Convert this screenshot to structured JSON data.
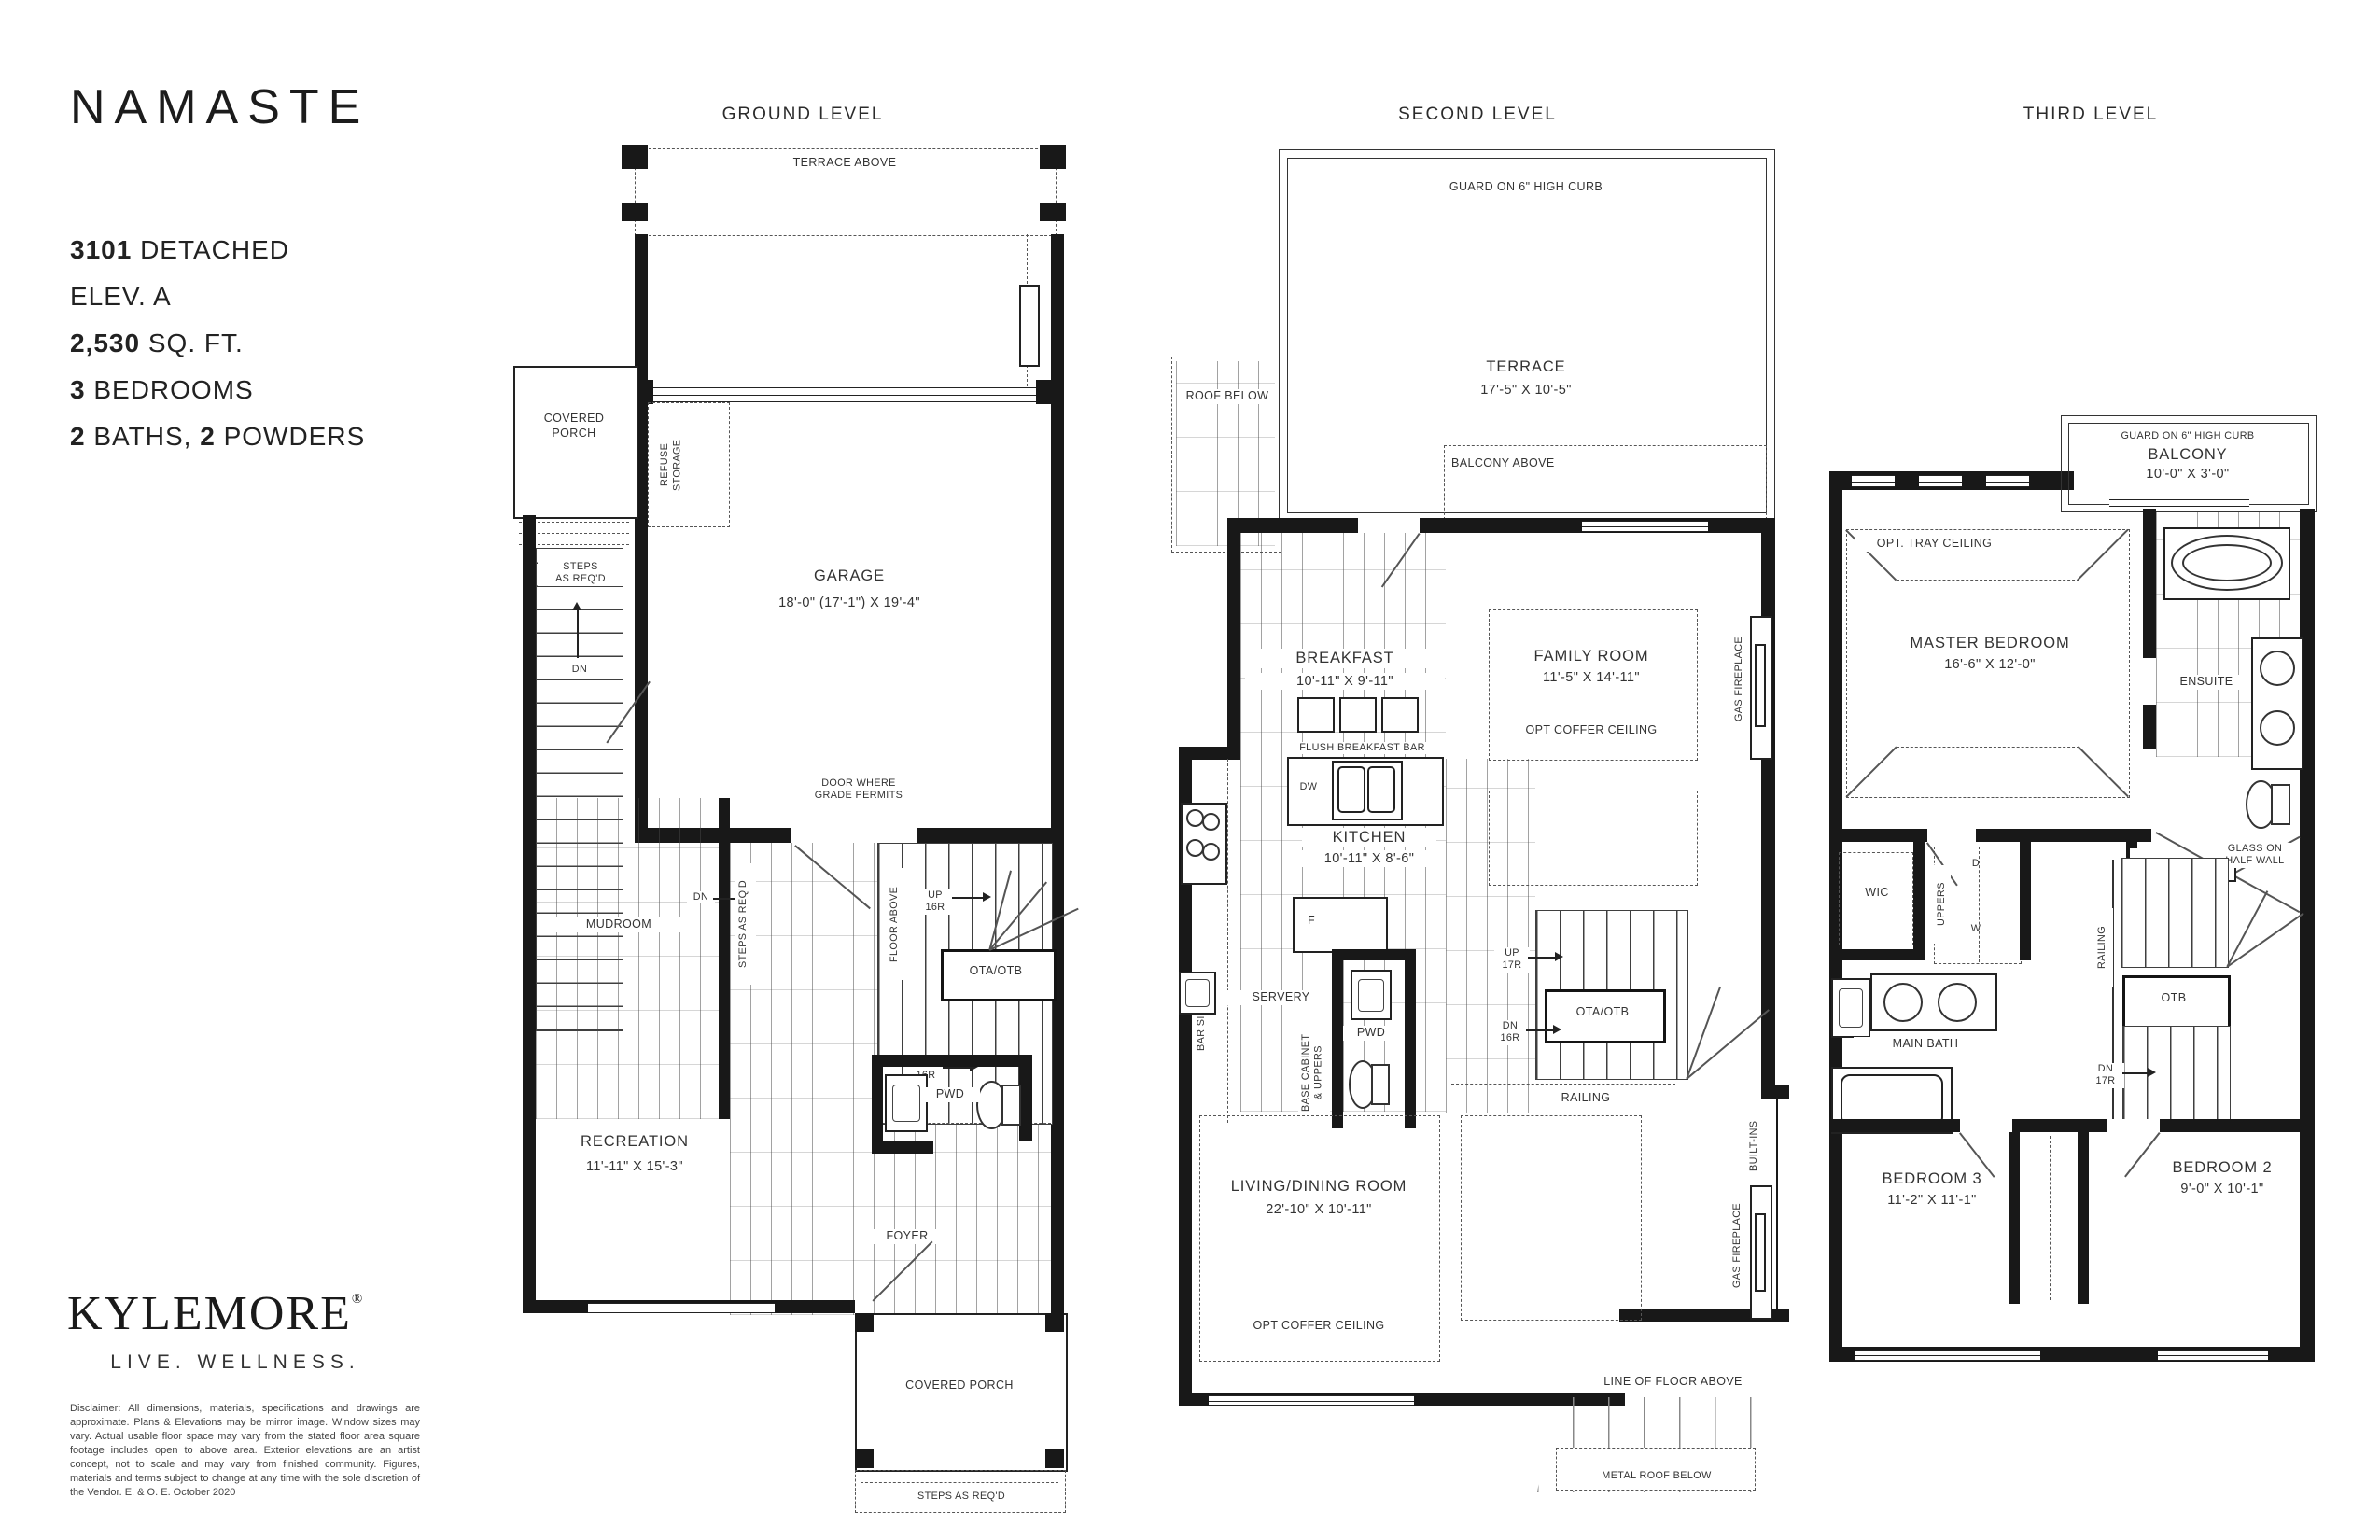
{
  "page": {
    "title": "NAMASTE",
    "model_num": "3101",
    "model_rest": "DETACHED",
    "elev": "ELEV. A",
    "sqft_num": "2,530",
    "sqft_rest": "SQ. FT.",
    "bed_num": "3",
    "bed_rest": "BEDROOMS",
    "bath_num": "2",
    "bath_rest": "BATHS,",
    "powder_num": "2",
    "powder_rest": "POWDERS"
  },
  "brand": {
    "name": "KYLEMORE",
    "reg": "®",
    "tagline": "LIVE. WELLNESS.",
    "disclaimer": "Disclaimer: All dimensions, materials, specifications and drawings are approximate. Plans & Elevations may be mirror image. Window sizes may vary. Actual usable floor space may vary from the stated floor area square footage includes open to above area. Exterior elevations are an artist concept, not to scale and may vary from finished community. Figures, materials and terms subject to change at any time with the sole discretion of the Vendor.  E. & O. E. October 2020"
  },
  "levels": {
    "ground": {
      "header": "GROUND LEVEL",
      "labels": {
        "terrace_above": "TERRACE ABOVE",
        "covered_porch": "COVERED\nPORCH",
        "steps_left": "STEPS\nAS REQ'D",
        "dn_left": "DN",
        "refuse": "REFUSE\nSTORAGE",
        "garage": "GARAGE",
        "garage_dims": "18'-0\" (17'-1\")  X 19'-4\"",
        "door_grade": "DOOR WHERE\nGRADE PERMITS",
        "mudroom": "MUDROOM",
        "dn_mid": "DN",
        "steps_v": "STEPS AS REQ'D",
        "floor_above": "FLOOR ABOVE",
        "up16r": "UP\n16R",
        "ota_otb": "OTA/OTB",
        "dn16r": "DN\n16R",
        "recreation": "RECREATION",
        "recreation_dims": "11'-11\" X 15'-3\"",
        "pwd": "PWD",
        "foyer": "FOYER",
        "covered_porch_bottom": "COVERED PORCH",
        "steps_bottom": "STEPS AS REQ'D"
      }
    },
    "second": {
      "header": "SECOND LEVEL",
      "labels": {
        "guard": "GUARD ON 6\" HIGH CURB",
        "terrace": "TERRACE",
        "terrace_dims": "17'-5\" X 10'-5\"",
        "roof_below": "ROOF BELOW",
        "balcony_above": "BALCONY ABOVE",
        "breakfast": "BREAKFAST",
        "breakfast_dims": "10'-11\" X 9'-11\"",
        "family": "FAMILY ROOM",
        "family_dims": "11'-5\" X 14'-11\"",
        "family_opt": "OPT COFFER CEILING",
        "gas_fp_top": "GAS FIREPLACE",
        "flush_bar": "FLUSH BREAKFAST BAR",
        "dw": "DW",
        "kitchen": "KITCHEN",
        "kitchen_dims": "10'-11\" X 8'-6\"",
        "fridge": "F",
        "servery": "SERVERY",
        "bar_sink": "BAR SINK",
        "base_cab": "BASE CABINET\n& UPPERS",
        "pwd": "PWD",
        "up17r": "UP\n17R",
        "ota_otb": "OTA/OTB",
        "dn16r": "DN\n16R",
        "railing": "RAILING",
        "built_ins": "BUILT-INS",
        "gas_fp_bottom": "GAS FIREPLACE",
        "living": "LIVING/DINING ROOM",
        "living_dims": "22'-10\" X 10'-11\"",
        "living_opt": "OPT COFFER CEILING",
        "line_floor": "LINE OF FLOOR ABOVE",
        "metal_roof": "METAL ROOF BELOW"
      }
    },
    "third": {
      "header": "THIRD LEVEL",
      "labels": {
        "guard": "GUARD ON 6\" HIGH CURB",
        "balcony": "BALCONY",
        "balcony_dims": "10'-0\" X 3'-0\"",
        "opt_tray": "OPT. TRAY CEILING",
        "master": "MASTER BEDROOM",
        "master_dims": "16'-6\" X 12'-0\"",
        "ensuite": "ENSUITE",
        "wic": "WIC",
        "uppers": "UPPERS",
        "d": "D",
        "w": "W",
        "linen": "LINEN",
        "glass_half": "GLASS ON\nHALF WALL",
        "railing": "RAILING",
        "main_bath": "MAIN BATH",
        "otb": "OTB",
        "dn17r": "DN\n17R",
        "bedroom3": "BEDROOM 3",
        "bedroom3_dims": "11'-2\" X 11'-1\"",
        "bedroom2": "BEDROOM 2",
        "bedroom2_dims": "9'-0\" X 10'-1\""
      }
    }
  }
}
